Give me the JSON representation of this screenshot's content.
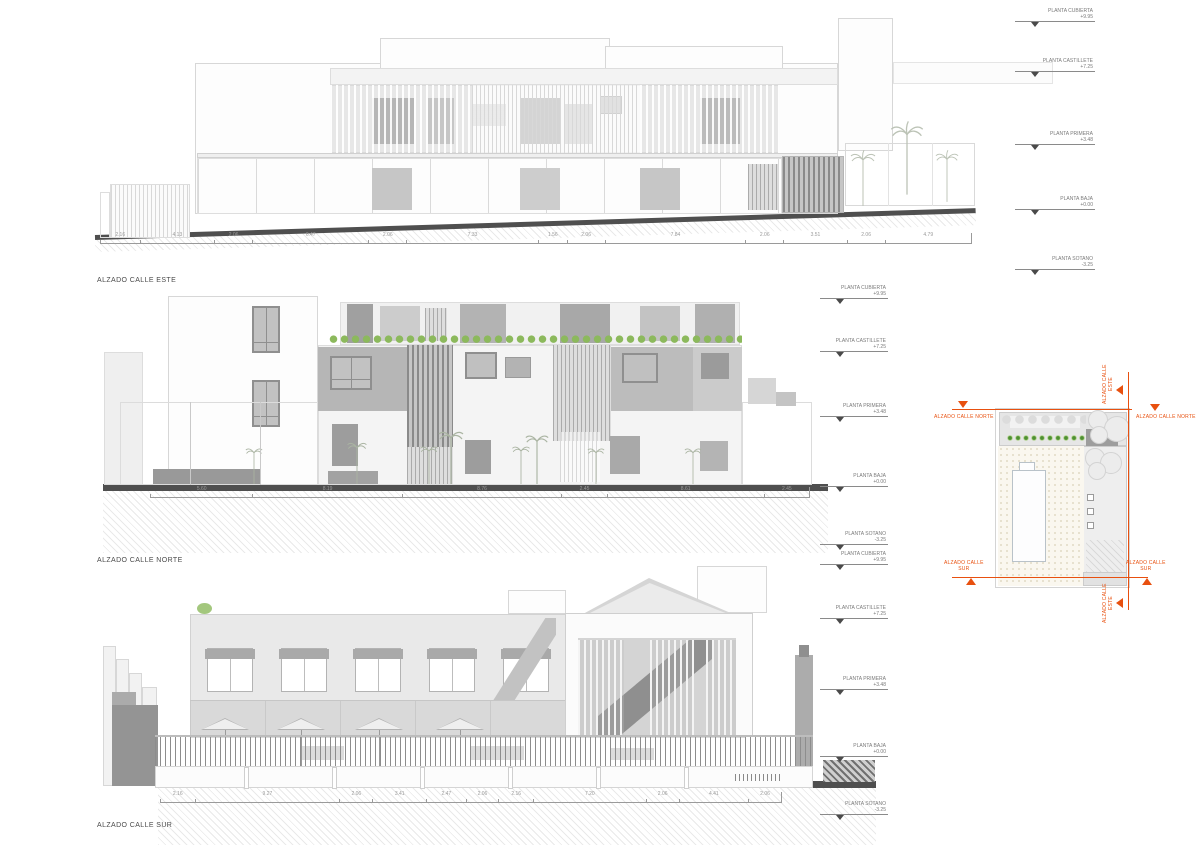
{
  "titles": {
    "east": "ALZADO CALLE ESTE",
    "north": "ALZADO CALLE NORTE",
    "south": "ALZADO CALLE SUR"
  },
  "levels": [
    {
      "label": "PLANTA CUBIERTA",
      "value": "+9.95"
    },
    {
      "label": "PLANTA CASTILLETE",
      "value": "+7.25"
    },
    {
      "label": "PLANTA PRIMERA",
      "value": "+3.48"
    },
    {
      "label": "PLANTA BAJA",
      "value": "+0.00"
    },
    {
      "label": "PLANTA SOTANO",
      "value": "-3.25"
    }
  ],
  "dims": {
    "east": [
      "2.16",
      "4.13",
      "2.06",
      "6.47",
      "2.06",
      "7.33",
      "1.56",
      "2.06",
      "7.84",
      "2.06",
      "3.51",
      "2.06",
      "4.79"
    ],
    "north": [
      "5.60",
      "8.19",
      "8.76",
      "2.45",
      "8.61",
      "2.45"
    ],
    "south": [
      "2.16",
      "9.27",
      "2.06",
      "3.41",
      "2.47",
      "2.06",
      "2.16",
      "7.20",
      "2.06",
      "4.41",
      "2.06"
    ]
  },
  "siteplan": {
    "label_north": "ALZADO CALLE NORTE",
    "label_south_1": "ALZADO CALLE",
    "label_south_2": "SUR",
    "label_east_1": "ALZADO CALLE",
    "label_east_2": "ESTE"
  },
  "colors": {
    "accent_orange": "#E8500F",
    "bush_green": "#8CB95C",
    "ground_dark": "#4F4F4F"
  }
}
